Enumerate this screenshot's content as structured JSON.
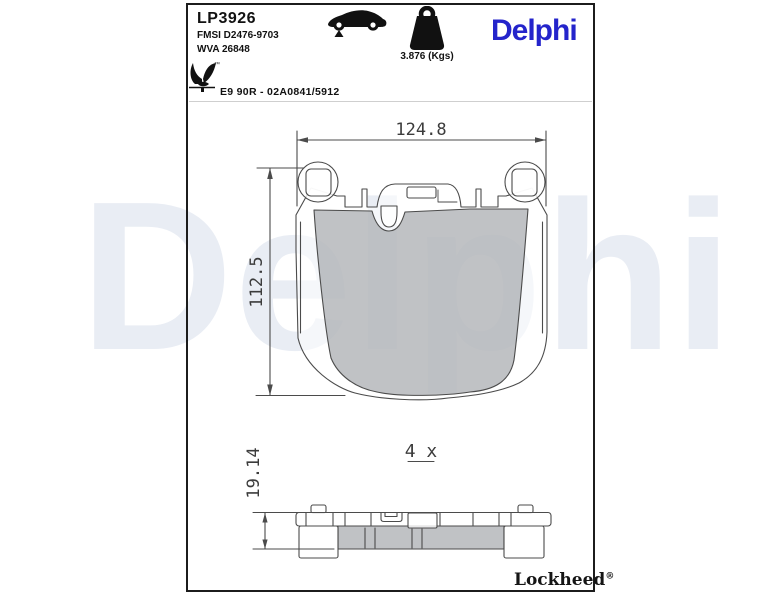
{
  "page": {
    "watermark_text": "Delphi"
  },
  "header": {
    "part_number": "LP3926",
    "fmsi_code": "FMSI D2476-9703",
    "wva_code": "WVA 26848",
    "weight": "3.876 (Kgs)",
    "brand_logo": "Delphi",
    "homologation": "E9 90R - 02A0841/5912",
    "trademark": "™"
  },
  "drawing": {
    "front_view": {
      "width_mm": "124.8",
      "height_mm": "112.5"
    },
    "side_view": {
      "thickness_mm": "19.14",
      "quantity": "4 x"
    }
  },
  "footer": {
    "brand": "Lockheed",
    "registered": "®"
  },
  "colors": {
    "brand_blue": "#2424cb",
    "watermark_blue": "#e9edf4",
    "pad_gray": "#c5c7ca",
    "line_gray": "#4b4b4b"
  }
}
